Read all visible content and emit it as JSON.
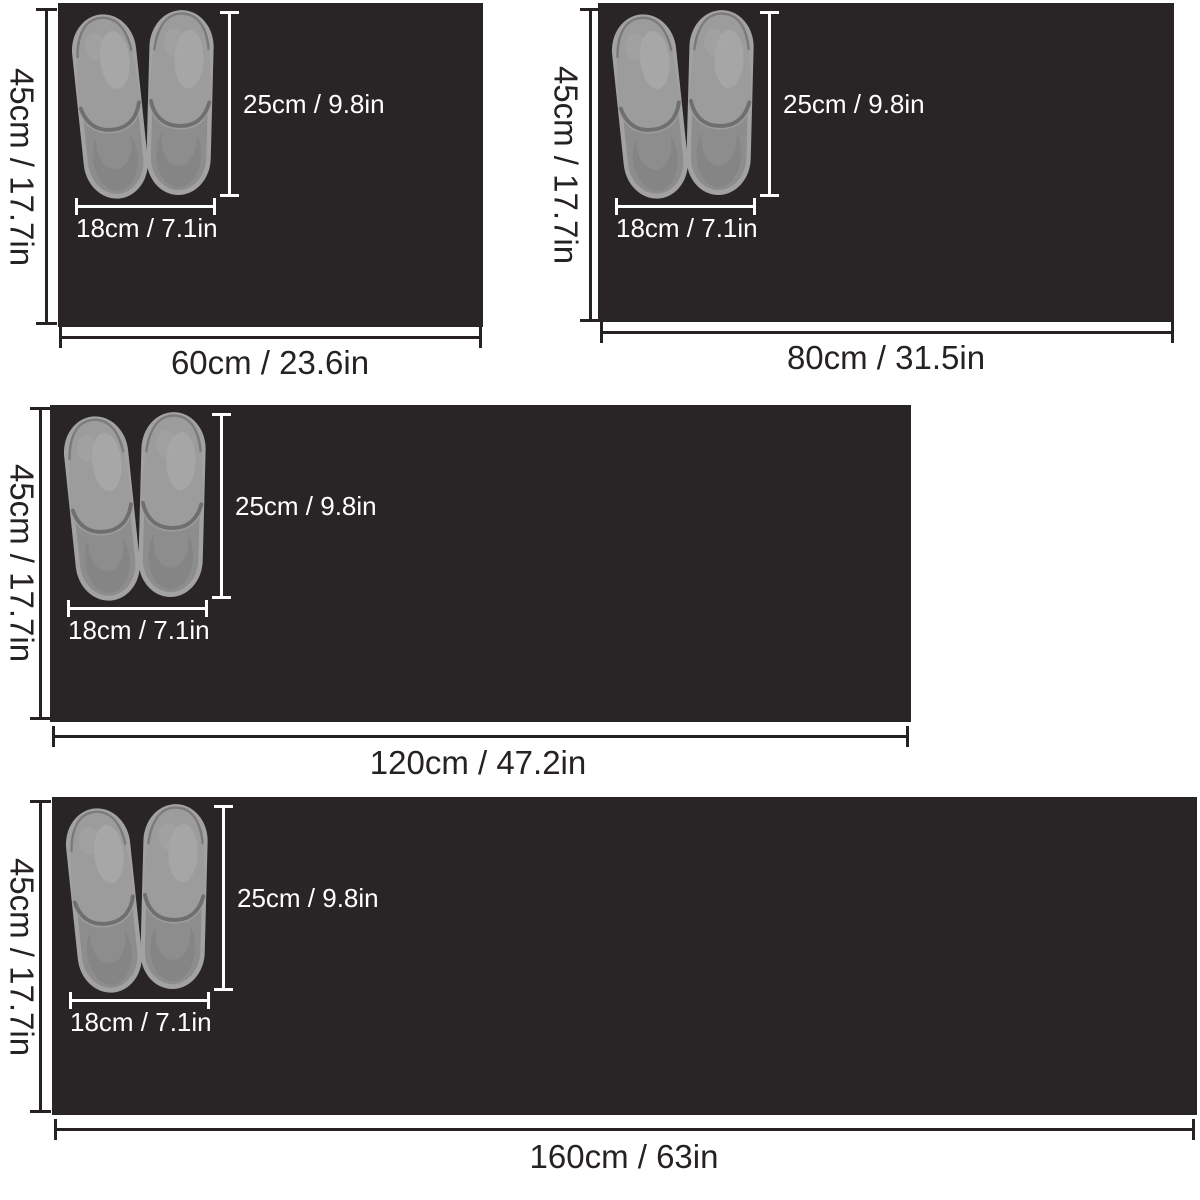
{
  "canvas": {
    "description": "Mat size comparison diagram with four black mats and slipper scale reference",
    "slippers_alt": "Pair of gray closed-toe slippers viewed from above"
  },
  "colors": {
    "background": "#ffffff",
    "mat_surface": "#292526",
    "dimension_dark": "#262122",
    "dimension_light": "#ffffff",
    "slipper_upper": "#9c9c9c",
    "slipper_footbed": "#8d8d8d",
    "slipper_rim": "#a2a2a2"
  },
  "mats": [
    {
      "name": "mat-60",
      "width_label": "60cm / 23.6in",
      "height_label": "45cm / 17.7in",
      "slipper_length_label": "25cm / 9.8in",
      "slipper_width_label": "18cm / 7.1in"
    },
    {
      "name": "mat-80",
      "width_label": "80cm / 31.5in",
      "height_label": "45cm / 17.7in",
      "slipper_length_label": "25cm / 9.8in",
      "slipper_width_label": "18cm / 7.1in"
    },
    {
      "name": "mat-120",
      "width_label": "120cm / 47.2in",
      "height_label": "45cm / 17.7in",
      "slipper_length_label": "25cm / 9.8in",
      "slipper_width_label": "18cm / 7.1in"
    },
    {
      "name": "mat-160",
      "width_label": "160cm / 63in",
      "height_label": "45cm / 17.7in",
      "slipper_length_label": "25cm / 9.8in",
      "slipper_width_label": "18cm / 7.1in"
    }
  ]
}
